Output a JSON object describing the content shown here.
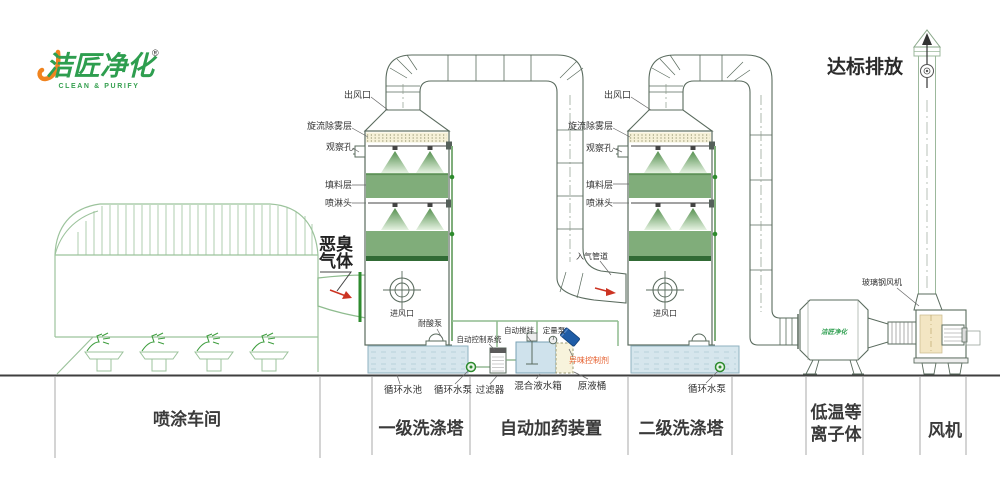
{
  "logo": {
    "brand": "洁匠净化",
    "reg": "®",
    "tagline": "CLEAN & PURIFY"
  },
  "headline": {
    "emission": "达标排放",
    "odor_gas_1": "恶臭",
    "odor_gas_2": "气体"
  },
  "tower_callouts": {
    "outlet": "出风口",
    "demister": "旋流除雾层",
    "viewport": "观察孔",
    "packing": "填料层",
    "spray_head": "喷淋头",
    "air_inlet": "进风口",
    "gas_inlet_pipe": "入气管道"
  },
  "equipment": {
    "acid_pump": "耐酸泵",
    "auto_control": "自动控制系统",
    "auto_stir": "自动搅拌",
    "metering_pump": "定量泵",
    "odor_agent": "异味控制剂",
    "circ_pool": "循环水池",
    "circ_pump": "循环水泵",
    "filter": "过滤器",
    "mix_tank": "混合液水箱",
    "raw_barrel": "原液桶",
    "fan_device": "玻璃钢风机",
    "plasma_logo": "洁匠净化"
  },
  "sections": {
    "workshop": "喷涂车间",
    "tower1": "一级洗涤塔",
    "dosing": "自动加药装置",
    "tower2": "二级洗涤塔",
    "plasma_1": "低温等",
    "plasma_2": "离子体",
    "fan": "风机"
  },
  "colors": {
    "brand_green": "#2e9e4f",
    "brand_orange": "#f0831e",
    "line_green": "#9cc39c",
    "packing_green": "#80ad7a",
    "water_blue": "#d6e6ed",
    "alert_orange": "#e55c2a",
    "arrow_red": "#cc3322",
    "barrel_blue": "#1e5ca6"
  }
}
